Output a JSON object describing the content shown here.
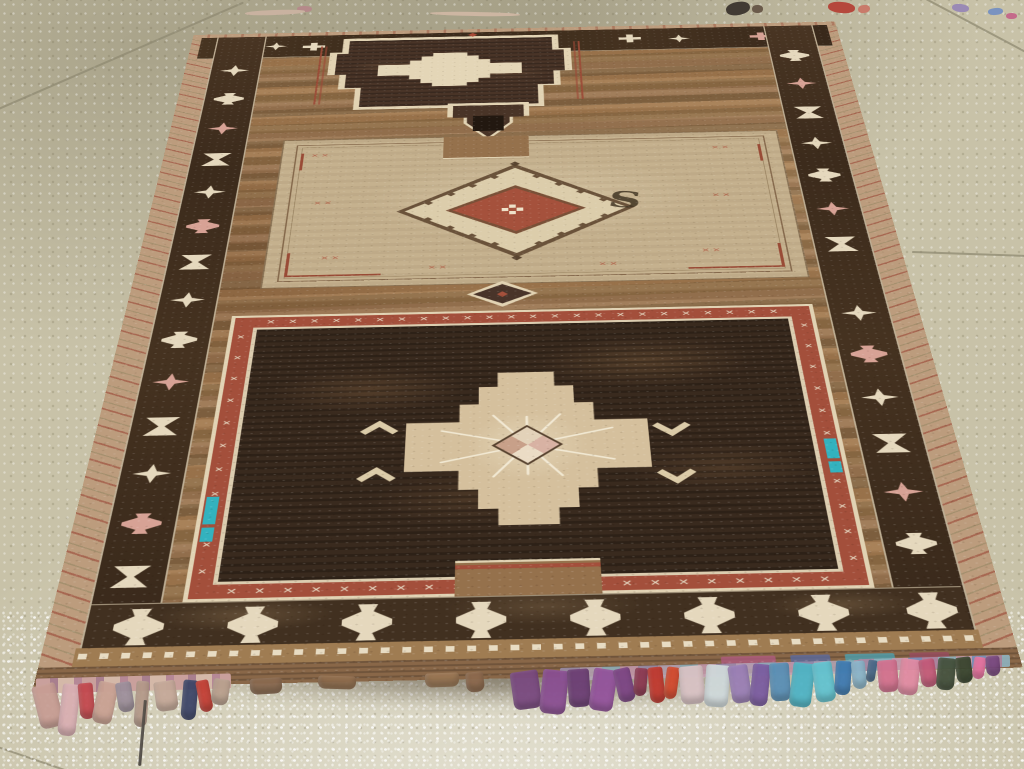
{
  "scene": {
    "description": "Photograph of a vintage hand-woven tribal area rug lying in perspective on a speckled beige tile floor",
    "subject": "brown tribal rug with three stacked medallions, dark geometric borders and multicolor end tassels"
  },
  "palette": {
    "floor": "#c8c2a8",
    "grout": "#8f8a72",
    "field": "#96714a",
    "field_dark": "#7e5f3c",
    "border_dark": "#42301f",
    "cream": "#e6d8bc",
    "pink": "#d9a294",
    "red": "#ab4a36",
    "panel_cream": "#c6b18c",
    "panel_dark": "#3a2a1d",
    "rust": "#9c4a34",
    "teal": "#2fb3c0",
    "selvage_tan": "#bd9c7c",
    "kilim": "#8a6747",
    "black_core": "#221810"
  },
  "glyphs": {
    "s": "S",
    "r": "R",
    "cross": "✕"
  },
  "cross_rows": {
    "top_count": 24,
    "bottom_count": 22,
    "side_count": 11
  },
  "border_motifs": {
    "left": [
      {
        "y": 100,
        "s": "star",
        "c": "cream"
      },
      {
        "y": 196,
        "s": "goblet",
        "c": "cream"
      },
      {
        "y": 292,
        "s": "star",
        "c": "pink"
      },
      {
        "y": 388,
        "s": "hourglass",
        "c": "cream"
      },
      {
        "y": 484,
        "s": "star",
        "c": "cream"
      },
      {
        "y": 580,
        "s": "goblet",
        "c": "pink"
      },
      {
        "y": 676,
        "s": "hourglass",
        "c": "cream"
      },
      {
        "y": 772,
        "s": "star",
        "c": "cream"
      },
      {
        "y": 868,
        "s": "goblet",
        "c": "cream"
      },
      {
        "y": 964,
        "s": "star",
        "c": "pink"
      },
      {
        "y": 1060,
        "s": "hourglass",
        "c": "cream"
      },
      {
        "y": 1156,
        "s": "star",
        "c": "cream"
      },
      {
        "y": 1252,
        "s": "goblet",
        "c": "pink"
      },
      {
        "y": 1348,
        "s": "hourglass",
        "c": "cream"
      }
    ],
    "right": [
      {
        "y": 88,
        "s": "goblet",
        "c": "cream"
      },
      {
        "y": 184,
        "s": "star",
        "c": "pink"
      },
      {
        "y": 280,
        "s": "hourglass",
        "c": "cream"
      },
      {
        "y": 376,
        "s": "star",
        "c": "cream"
      },
      {
        "y": 472,
        "s": "goblet",
        "c": "cream"
      },
      {
        "y": 568,
        "s": "star",
        "c": "pink"
      },
      {
        "y": 664,
        "s": "hourglass",
        "c": "cream"
      },
      {
        "y": 838,
        "s": "star",
        "c": "cream"
      },
      {
        "y": 934,
        "s": "goblet",
        "c": "pink"
      },
      {
        "y": 1030,
        "s": "star",
        "c": "cream"
      },
      {
        "y": 1126,
        "s": "hourglass",
        "c": "cream"
      },
      {
        "y": 1222,
        "s": "star",
        "c": "pink"
      },
      {
        "y": 1318,
        "s": "goblet",
        "c": "cream"
      }
    ],
    "top": [
      {
        "x": 100,
        "y": 22,
        "s": "star",
        "c": "cream"
      },
      {
        "x": 158,
        "y": 26,
        "s": "cross",
        "c": "cream"
      },
      {
        "x": 640,
        "y": 20,
        "s": "cross",
        "c": "cream"
      },
      {
        "x": 715,
        "y": 24,
        "s": "star",
        "c": "cream"
      },
      {
        "x": 840,
        "y": 22,
        "s": "cross",
        "c": "pink"
      },
      {
        "x": 900,
        "y": 26,
        "s": "star",
        "c": "cream"
      }
    ],
    "bottom": [
      {
        "x": 28,
        "s": "goblet",
        "c": "cream"
      },
      {
        "x": 146,
        "s": "goblet",
        "c": "cream"
      },
      {
        "x": 264,
        "s": "goblet",
        "c": "cream"
      },
      {
        "x": 382,
        "s": "goblet",
        "c": "cream"
      },
      {
        "x": 500,
        "s": "goblet",
        "c": "cream"
      },
      {
        "x": 618,
        "s": "goblet",
        "c": "cream"
      },
      {
        "x": 736,
        "s": "goblet",
        "c": "cream"
      },
      {
        "x": 848,
        "s": "goblet",
        "c": "cream"
      }
    ]
  },
  "x_clusters": [
    {
      "x": 40,
      "y": 40
    },
    {
      "x": 600,
      "y": 40
    },
    {
      "x": 52,
      "y": 180
    },
    {
      "x": 590,
      "y": 180
    },
    {
      "x": 70,
      "y": 330
    },
    {
      "x": 565,
      "y": 330
    },
    {
      "x": 210,
      "y": 360
    },
    {
      "x": 430,
      "y": 360
    }
  ],
  "kilim_patches": [
    {
      "left": 690,
      "w": 55,
      "c": "#b05a80"
    },
    {
      "left": 760,
      "w": 40,
      "c": "#5a6aa0"
    },
    {
      "left": 815,
      "w": 50,
      "c": "#4aa0b0"
    },
    {
      "left": 880,
      "w": 40,
      "c": "#9a4a60"
    }
  ],
  "bindings": [
    {
      "x": 36,
      "y": 676,
      "w": 195,
      "h": 15,
      "rot": -1.5,
      "type": "pink"
    },
    {
      "x": 560,
      "y": 664,
      "w": 300,
      "h": 13,
      "rot": -1.5,
      "type": "multi"
    },
    {
      "x": 858,
      "y": 657,
      "w": 152,
      "h": 12,
      "rot": -1.6,
      "type": "multi2"
    }
  ],
  "fringe": {
    "tassels": [
      {
        "x": 36,
        "y": 684,
        "w": 24,
        "h": 44,
        "c": "#c79d94",
        "r": -14
      },
      {
        "x": 60,
        "y": 684,
        "w": 18,
        "h": 52,
        "c": "#d8aeb2",
        "r": 7
      },
      {
        "x": 79,
        "y": 683,
        "w": 15,
        "h": 36,
        "c": "#c2484e",
        "r": -5
      },
      {
        "x": 95,
        "y": 682,
        "w": 20,
        "h": 42,
        "c": "#c9a193",
        "r": 12
      },
      {
        "x": 117,
        "y": 682,
        "w": 16,
        "h": 30,
        "c": "#9d8f9b",
        "r": -9
      },
      {
        "x": 135,
        "y": 681,
        "w": 13,
        "h": 46,
        "c": "#b59a8a",
        "r": 4
      },
      {
        "x": 141,
        "y": 700,
        "w": 3,
        "h": 66,
        "c": "#514a42",
        "r": 5
      },
      {
        "x": 155,
        "y": 681,
        "w": 22,
        "h": 30,
        "c": "#c4a898",
        "r": -8
      },
      {
        "x": 182,
        "y": 680,
        "w": 15,
        "h": 40,
        "c": "#3e4668",
        "r": 5
      },
      {
        "x": 198,
        "y": 680,
        "w": 13,
        "h": 32,
        "c": "#c23f35",
        "r": -11
      },
      {
        "x": 212,
        "y": 679,
        "w": 17,
        "h": 26,
        "c": "#b9a08e",
        "r": 9
      },
      {
        "x": 250,
        "y": 678,
        "w": 32,
        "h": 16,
        "c": "#8a6a50",
        "r": -3
      },
      {
        "x": 318,
        "y": 676,
        "w": 38,
        "h": 13,
        "c": "#937050",
        "r": 2
      },
      {
        "x": 425,
        "y": 673,
        "w": 34,
        "h": 14,
        "c": "#9b7856",
        "r": -2
      },
      {
        "x": 466,
        "y": 672,
        "w": 18,
        "h": 20,
        "c": "#8d6a4e",
        "r": -6
      },
      {
        "x": 512,
        "y": 671,
        "w": 28,
        "h": 38,
        "c": "#7a4a80",
        "r": -8
      },
      {
        "x": 541,
        "y": 670,
        "w": 26,
        "h": 44,
        "c": "#8a4f92",
        "r": 6
      },
      {
        "x": 568,
        "y": 669,
        "w": 22,
        "h": 38,
        "c": "#6c3f74",
        "r": -4
      },
      {
        "x": 591,
        "y": 669,
        "w": 24,
        "h": 42,
        "c": "#93539b",
        "r": 9
      },
      {
        "x": 616,
        "y": 668,
        "w": 17,
        "h": 34,
        "c": "#7c4584",
        "r": -13
      },
      {
        "x": 634,
        "y": 668,
        "w": 13,
        "h": 28,
        "c": "#8d3a52",
        "r": 5
      },
      {
        "x": 649,
        "y": 667,
        "w": 15,
        "h": 36,
        "c": "#c0392f",
        "r": -6
      },
      {
        "x": 665,
        "y": 667,
        "w": 13,
        "h": 32,
        "c": "#d24a2e",
        "r": 8
      },
      {
        "x": 680,
        "y": 666,
        "w": 24,
        "h": 38,
        "c": "#d8c2c4",
        "r": -5
      },
      {
        "x": 705,
        "y": 665,
        "w": 24,
        "h": 42,
        "c": "#cfd8da",
        "r": 4
      },
      {
        "x": 730,
        "y": 665,
        "w": 20,
        "h": 38,
        "c": "#9a7fb5",
        "r": -9
      },
      {
        "x": 751,
        "y": 664,
        "w": 18,
        "h": 42,
        "c": "#7b5ca0",
        "r": 6
      },
      {
        "x": 770,
        "y": 663,
        "w": 20,
        "h": 38,
        "c": "#5a8fb5",
        "r": -4
      },
      {
        "x": 791,
        "y": 663,
        "w": 22,
        "h": 44,
        "c": "#4fb3c4",
        "r": 7
      },
      {
        "x": 814,
        "y": 662,
        "w": 20,
        "h": 40,
        "c": "#62c2cf",
        "r": -8
      },
      {
        "x": 835,
        "y": 661,
        "w": 16,
        "h": 34,
        "c": "#3f7ab0",
        "r": 4
      },
      {
        "x": 852,
        "y": 661,
        "w": 14,
        "h": 28,
        "c": "#8ab4c9",
        "r": -6
      },
      {
        "x": 867,
        "y": 660,
        "w": 9,
        "h": 22,
        "c": "#4a6a8a",
        "r": 9
      },
      {
        "x": 878,
        "y": 660,
        "w": 20,
        "h": 32,
        "c": "#d2708e",
        "r": -5
      },
      {
        "x": 899,
        "y": 659,
        "w": 20,
        "h": 36,
        "c": "#e08aa2",
        "r": 7
      },
      {
        "x": 920,
        "y": 659,
        "w": 16,
        "h": 28,
        "c": "#c25a78",
        "r": -9
      },
      {
        "x": 937,
        "y": 658,
        "w": 18,
        "h": 32,
        "c": "#44503c",
        "r": 5
      },
      {
        "x": 956,
        "y": 657,
        "w": 16,
        "h": 26,
        "c": "#39452f",
        "r": -7
      },
      {
        "x": 973,
        "y": 657,
        "w": 12,
        "h": 22,
        "c": "#e773a0",
        "r": 9
      },
      {
        "x": 986,
        "y": 656,
        "w": 14,
        "h": 20,
        "c": "#7a4a80",
        "r": -5
      }
    ]
  },
  "floor": {
    "grout_lines": [
      {
        "x": -6,
        "y": 110,
        "len": 272,
        "ang": -23.5
      },
      {
        "x": 912,
        "y": 251,
        "len": 118,
        "ang": 2
      },
      {
        "x": 926,
        "y": -2,
        "len": 114,
        "ang": 28
      },
      {
        "x": -8,
        "y": 744,
        "len": 86,
        "ang": 19
      }
    ],
    "debris": [
      {
        "x": 726,
        "y": 2,
        "w": 24,
        "h": 13,
        "c": "#413a33",
        "r": -10
      },
      {
        "x": 752,
        "y": 5,
        "w": 11,
        "h": 8,
        "c": "#6a5a4a",
        "r": 0
      },
      {
        "x": 828,
        "y": 2,
        "w": 27,
        "h": 11,
        "c": "#b5483c",
        "r": 5
      },
      {
        "x": 858,
        "y": 5,
        "w": 12,
        "h": 8,
        "c": "#c97a6a",
        "r": -8
      },
      {
        "x": 297,
        "y": 6,
        "w": 15,
        "h": 6,
        "c": "#b58a8a",
        "r": 0
      },
      {
        "x": 952,
        "y": 4,
        "w": 17,
        "h": 8,
        "c": "#9a8ab5",
        "r": 6
      },
      {
        "x": 988,
        "y": 8,
        "w": 15,
        "h": 7,
        "c": "#7a93c0",
        "r": -5
      },
      {
        "x": 1006,
        "y": 13,
        "w": 11,
        "h": 6,
        "c": "#c46a8a",
        "r": 0
      },
      {
        "x": 245,
        "y": 10,
        "w": 60,
        "h": 5,
        "c": "#c9b2a0",
        "r": -2
      },
      {
        "x": 430,
        "y": 12,
        "w": 90,
        "h": 4,
        "c": "#cdb6a2",
        "r": 1
      }
    ]
  }
}
